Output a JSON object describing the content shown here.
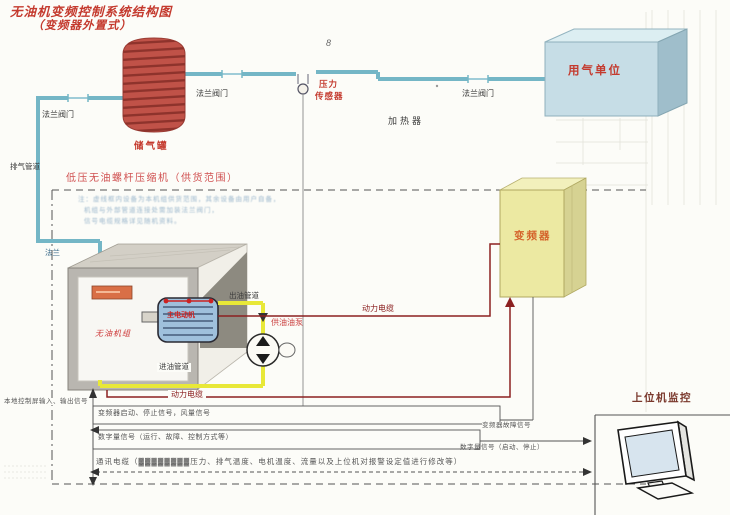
{
  "title": {
    "line1": "无油机变频控制系统结构图",
    "line2": "（变频器外置式）"
  },
  "labels": {
    "valve_left": "法兰阀门",
    "valve_mid": "法兰阀门",
    "valve_right": "法兰阀门",
    "storage_tank": "储气罐",
    "pressure_sensor_l1": "压力",
    "pressure_sensor_l2": "传感器",
    "heater": "加热器",
    "gas_user_unit": "用气单位",
    "exhaust_pipe": "排气管道",
    "supply_scope_title": "低压无油螺杆压缩机（供货范围）",
    "note1": "注：虚线框内设备为本机组供货范围，其余设备由用户自备，",
    "note2": "机组与外部管道连接处需加装法兰阀门，",
    "note3": "信号电缆规格详见随机资料。",
    "flange": "法兰",
    "unit_panel": "无油机组",
    "motor": "主电动机",
    "oil_out_pipe": "出油管道",
    "oil_supply_pump": "供油油泵",
    "oil_in_pipe": "进油管道",
    "power_cable_top": "动力电缆",
    "power_cable_bottom": "动力电缆",
    "inverter": "变频器",
    "local_panel_io": "本地控制屏输入、输出信号",
    "sig_start_stop": "变频器启动、停止信号，风量信号",
    "sig_digital_run": "数字量信号（运行、故障、控制方式等）",
    "comm_cable": "通讯电缆（▓▓▓▓▓▓▓▓压力、排气温度、电机温度、流量以及上位机对报警设定值进行修改等）",
    "inverter_fault": "变频器故障信号",
    "sig_digital_hostcmd": "数字量信号（启动、停止）",
    "host_monitor": "上位机监控",
    "handwritten_mark": "8"
  },
  "colors": {
    "accent_red_text": "#c43a2e",
    "pipe_blue": "#74b6c6",
    "cable_dark_red": "#8b2020",
    "tank_red": "#c05248",
    "gas_user_box_blue": "#c6dde6",
    "inverter_yellow": "#ece9a2",
    "oil_pipe_yellow": "#e8e838"
  }
}
